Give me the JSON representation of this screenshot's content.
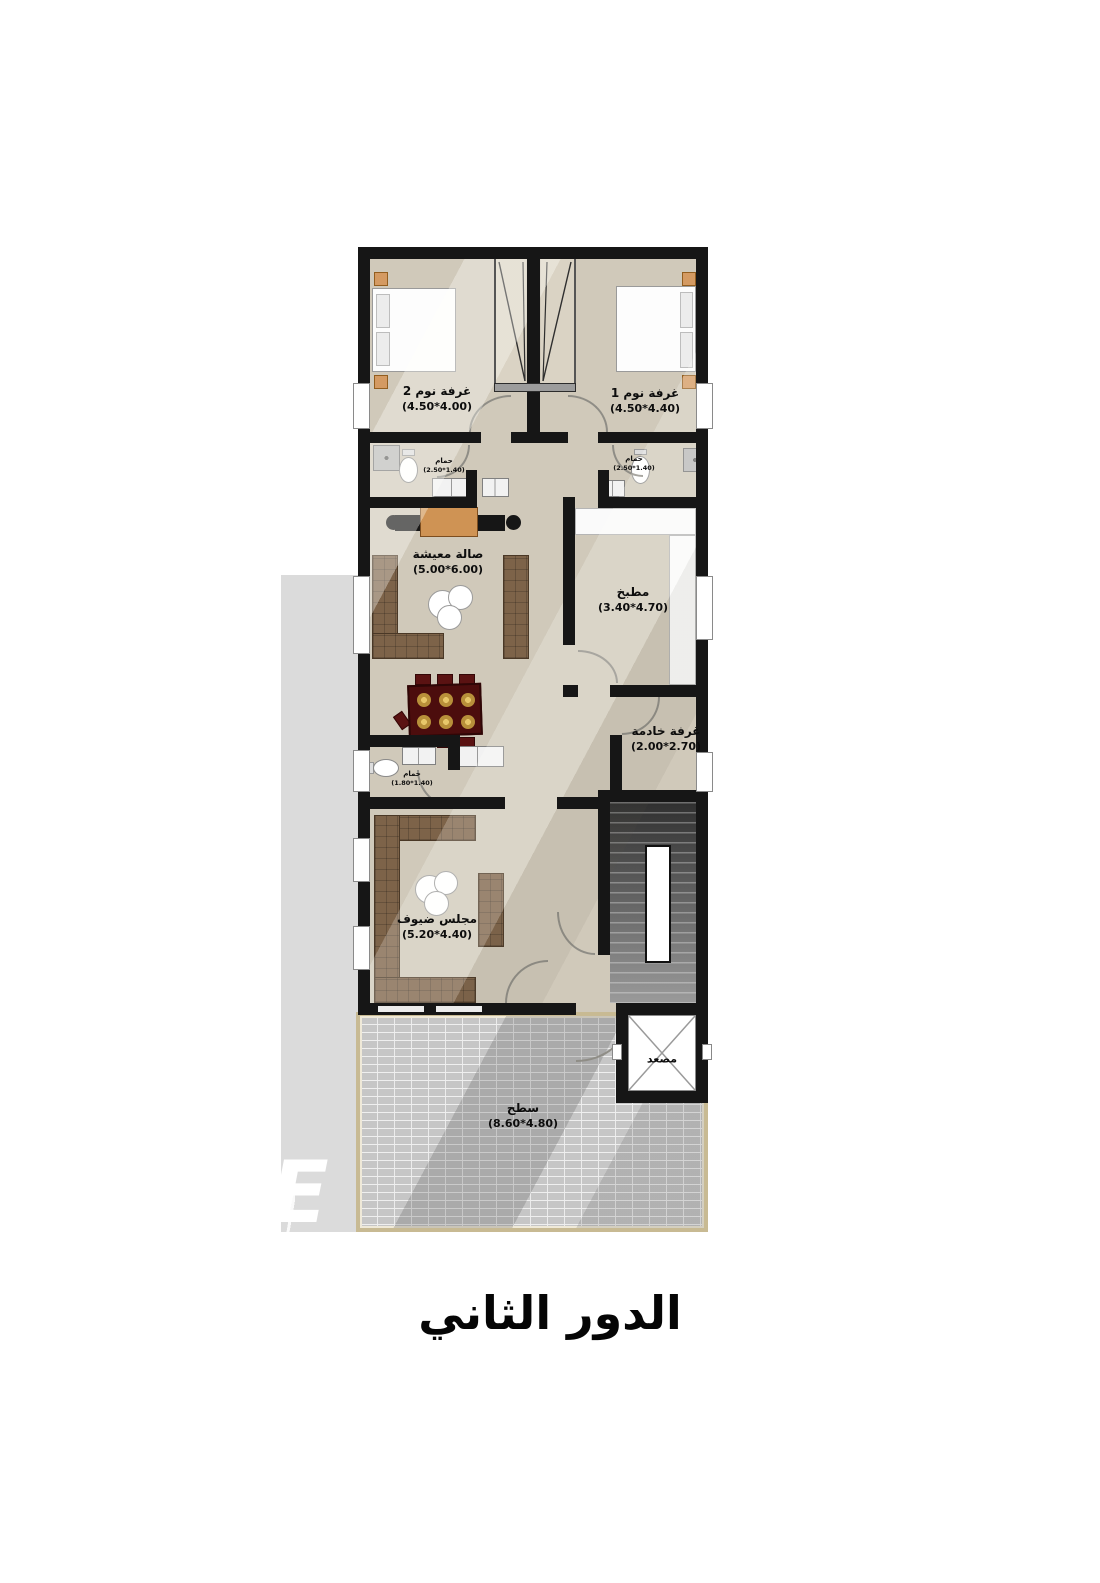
{
  "title": "الدور الثاني",
  "watermark": "E",
  "rooms": {
    "bedroom2": {
      "name": "غرفة نوم 2",
      "dims": "(4.50*4.00)"
    },
    "bedroom1": {
      "name": "غرفة نوم 1",
      "dims": "(4.50*4.40)"
    },
    "bath2": {
      "name": "حمام",
      "dims": "(2.50*1.40)"
    },
    "bath1": {
      "name": "حمام",
      "dims": "(2.50*1.40)"
    },
    "living": {
      "name": "صالة معيشة",
      "dims": "(5.00*6.00)"
    },
    "kitchen": {
      "name": "مطبخ",
      "dims": "(3.40*4.70)"
    },
    "maid": {
      "name": "غرفة خادمة",
      "dims": "(2.00*2.70)"
    },
    "bath3": {
      "name": "حمام",
      "dims": "(1.80*1.40)"
    },
    "majlis": {
      "name": "مجلس ضيوف",
      "dims": "(5.20*4.40)"
    },
    "roof": {
      "name": "سطح",
      "dims": "(8.60*4.80)"
    },
    "elevator": {
      "name": "مصعد"
    }
  },
  "colors": {
    "wall": "#161616",
    "floor": "#d0c9ba",
    "sofa": "#7d6349",
    "dining_table": "#4c0d0d",
    "gold": "#c09a3e",
    "wood_accent": "#cf9354",
    "brick": "#c6c6c6",
    "terrace_border": "#c8ba93",
    "shadow": "#dbdbdb"
  }
}
